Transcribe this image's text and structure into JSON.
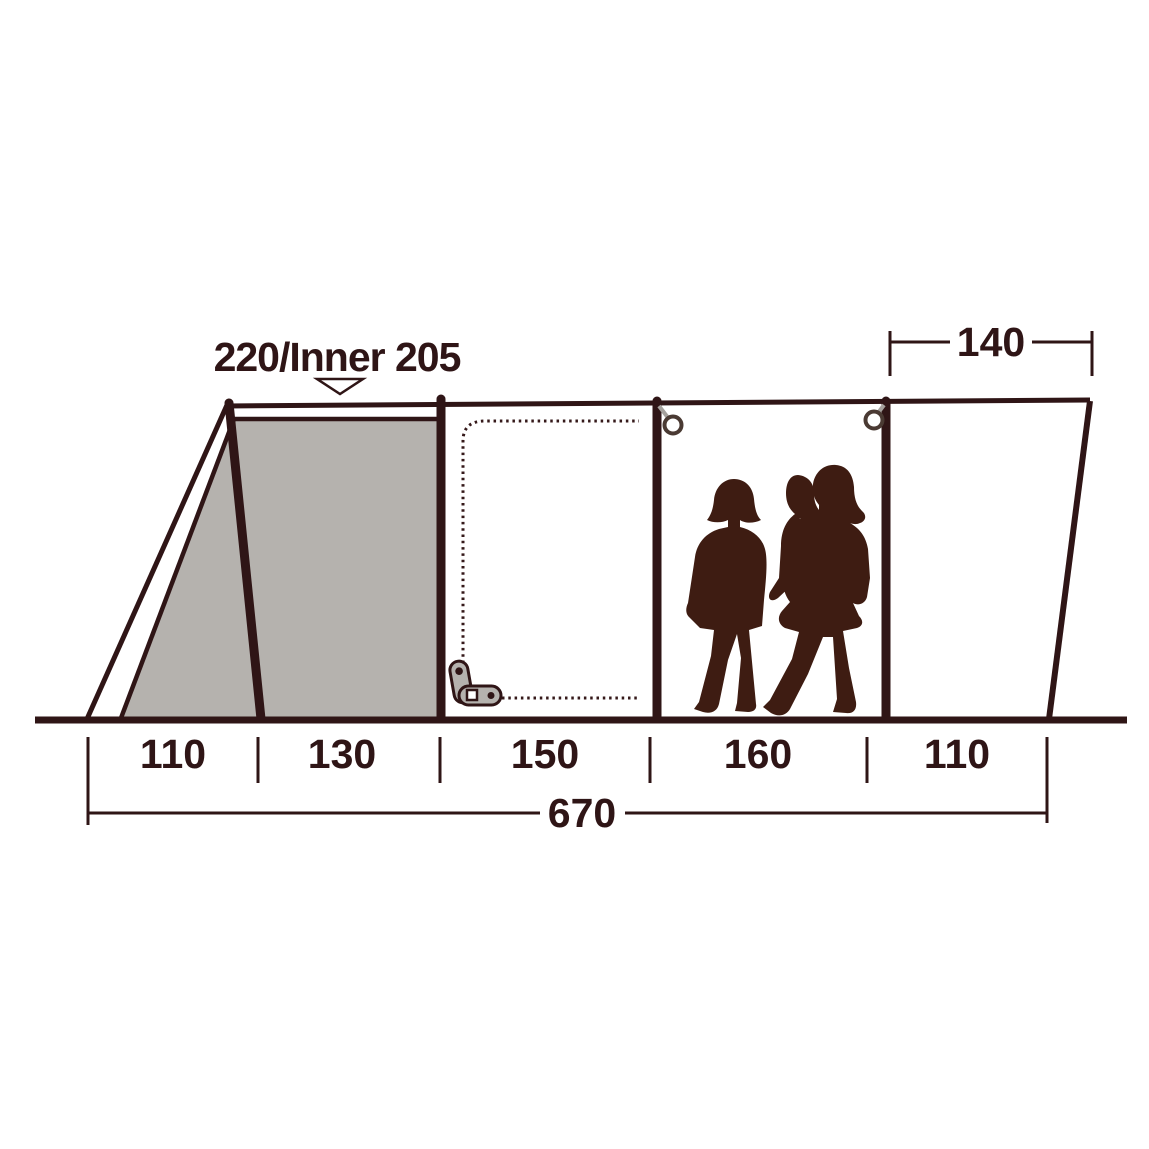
{
  "diagram": {
    "type": "tent-side-profile-dimension-diagram",
    "height_label": "220/Inner 205",
    "top_width_label": "140",
    "total_length_label": "670",
    "sections": [
      {
        "label": "110"
      },
      {
        "label": "130"
      },
      {
        "label": "150"
      },
      {
        "label": "160"
      },
      {
        "label": "110"
      }
    ],
    "colors": {
      "background": "#ffffff",
      "line_dark": "#2f1516",
      "inner_tent_gray": "#b5b2ae",
      "silhouette_brown": "#3e1c12",
      "ring_gray": "#a5a19d"
    }
  }
}
